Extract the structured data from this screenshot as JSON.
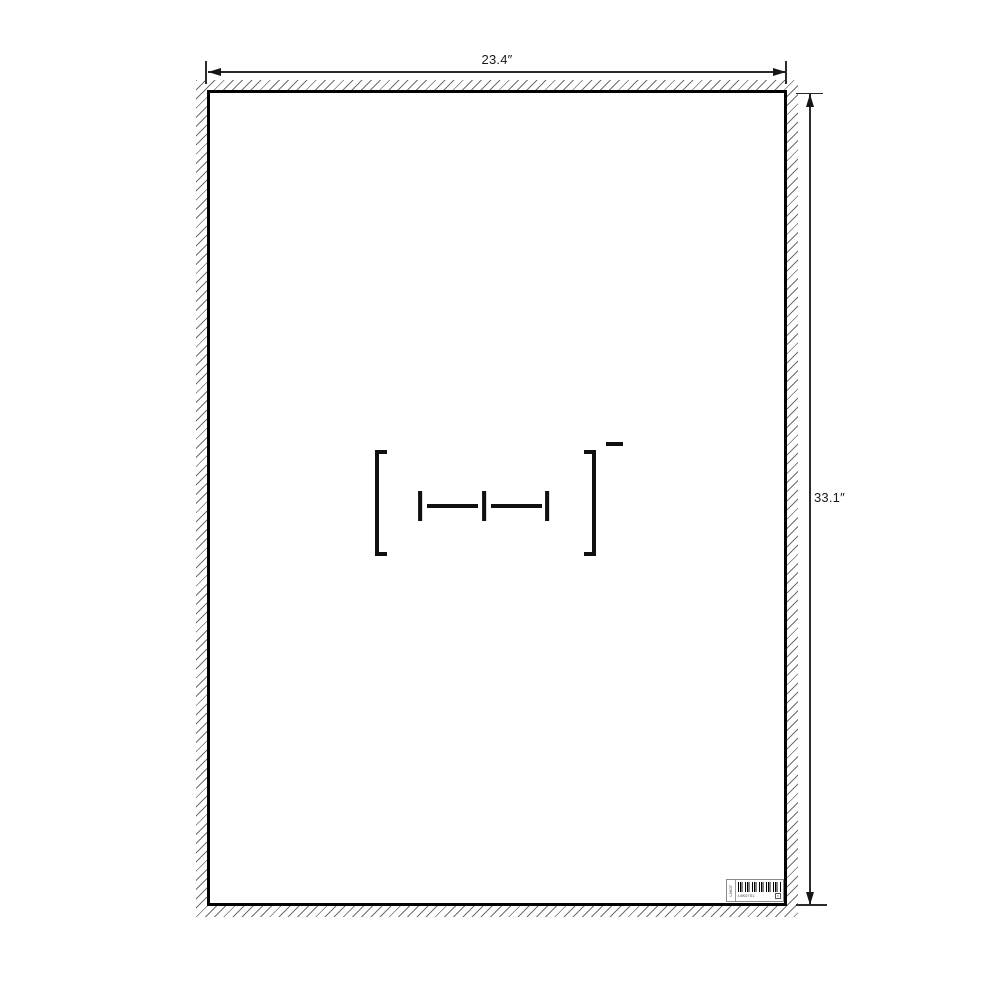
{
  "canvas": {
    "background": "#ffffff",
    "line_color": "#161616",
    "hatch_color": "#6f6f6f"
  },
  "poster": {
    "width_label": "23.4″",
    "height_label": "33.1″",
    "border_color": "#000000"
  },
  "structure": {
    "atoms": [
      "I",
      "I",
      "I"
    ],
    "charge_symbol": "−",
    "bond_count": 2
  },
  "sticker": {
    "side_text": "L5K07",
    "code_text": "L5K07S1",
    "box_glyph": "K"
  }
}
